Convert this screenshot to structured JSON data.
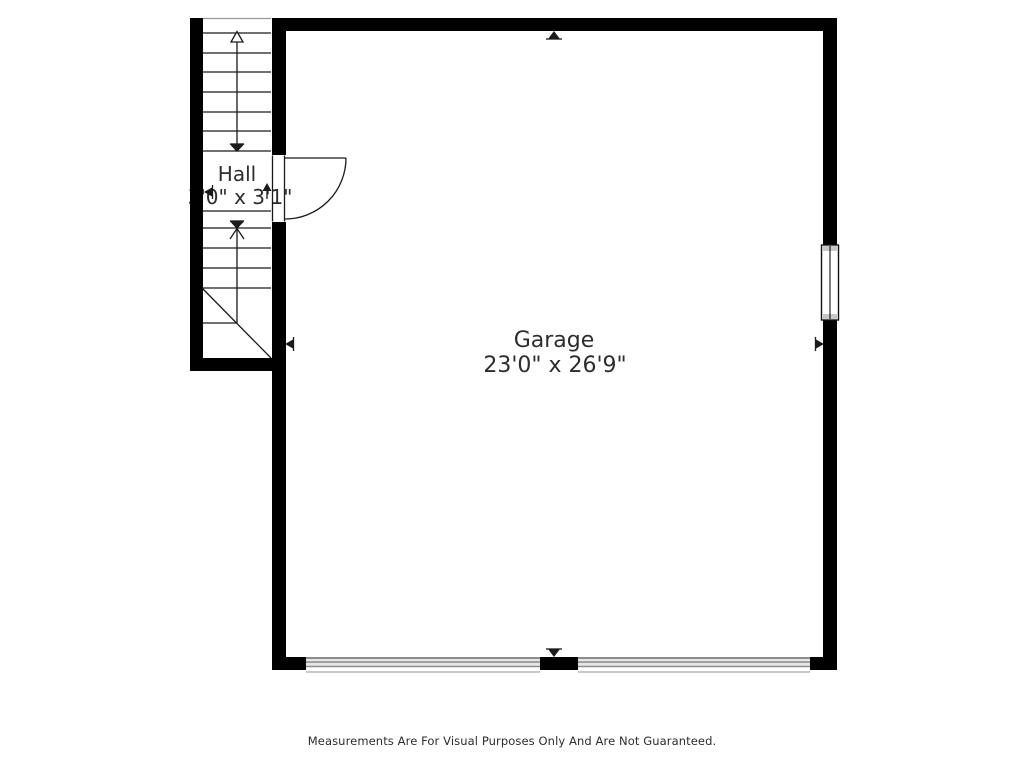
{
  "rooms": {
    "garage": {
      "name": "Garage",
      "dimensions": "23'0\" x 26'9\""
    },
    "hall": {
      "name": "Hall",
      "dimensions": "3'0\" x 3'1\""
    }
  },
  "footer": {
    "disclaimer": "Measurements Are For Visual Purposes Only And Are Not Guaranteed."
  },
  "colors": {
    "wall": "#000000",
    "line": "#1a1a1a",
    "muted_line": "#999999",
    "door_band_dark": "#8c8c8c",
    "door_band_light": "#e6e6e6",
    "window_cap": "#c8c8c8",
    "text": "#2d2d2d",
    "background": "#ffffff"
  }
}
